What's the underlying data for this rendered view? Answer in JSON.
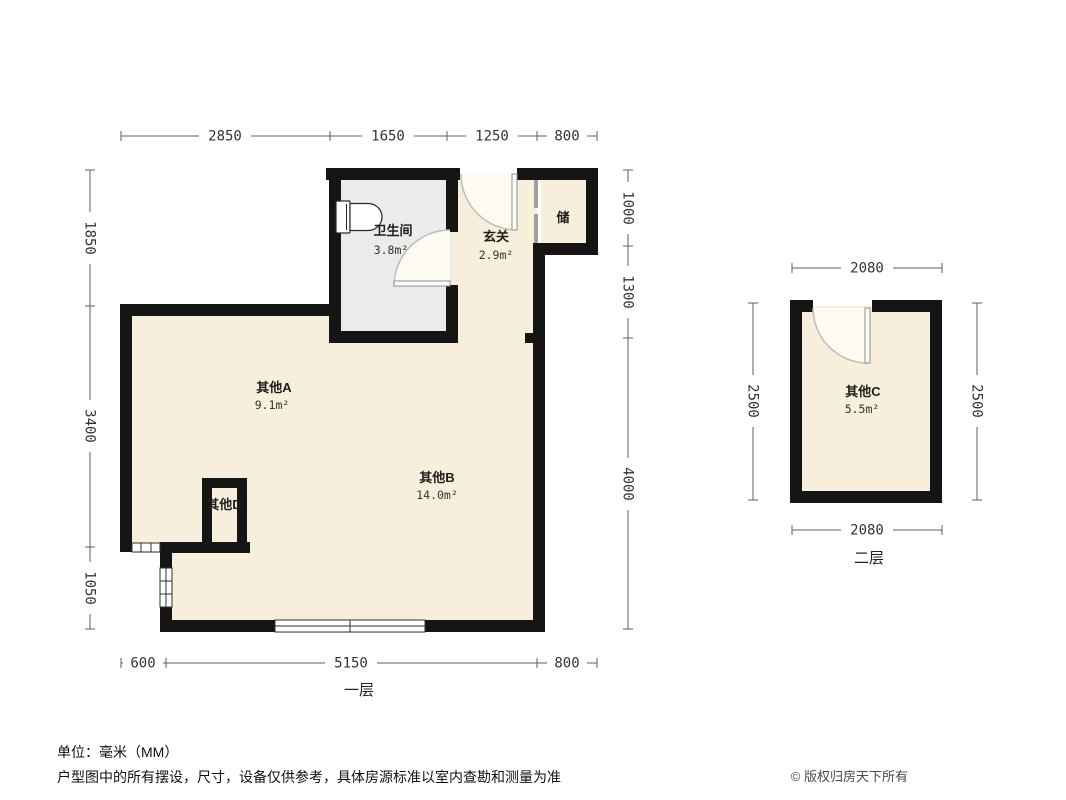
{
  "footer": {
    "unit_note": "单位：毫米（MM）",
    "disclaimer": "户型图中的所有摆设，尺寸，设备仅供参考，具体房源标准以室内查勘和测量为准",
    "copyright": "© 版权归房天下所有"
  },
  "floor1": {
    "label": "一层",
    "rooms": {
      "bathroom": {
        "name": "卫生间",
        "area": "3.8m²"
      },
      "entry": {
        "name": "玄关",
        "area": "2.9m²"
      },
      "storage": {
        "name": "储"
      },
      "otherA": {
        "name": "其他A",
        "area": "9.1m²"
      },
      "otherB": {
        "name": "其他B",
        "area": "14.0m²"
      },
      "otherD": {
        "name": "其他D"
      }
    },
    "dims": {
      "top": [
        "2850",
        "1650",
        "1250",
        "800"
      ],
      "left": [
        "1850",
        "3400",
        "1050"
      ],
      "right": [
        "1000",
        "1300",
        "4000"
      ],
      "bottom": [
        "600",
        "5150",
        "800"
      ]
    }
  },
  "floor2": {
    "label": "二层",
    "rooms": {
      "otherC": {
        "name": "其他C",
        "area": "5.5m²"
      }
    },
    "dims": {
      "top": "2080",
      "bottom": "2080",
      "left": "2500",
      "right": "2500"
    }
  },
  "colors": {
    "wall": "#151515",
    "floor": "#f7efdb",
    "bathroom_floor": "#ebebeb",
    "dimension": "#5f5f5f"
  }
}
